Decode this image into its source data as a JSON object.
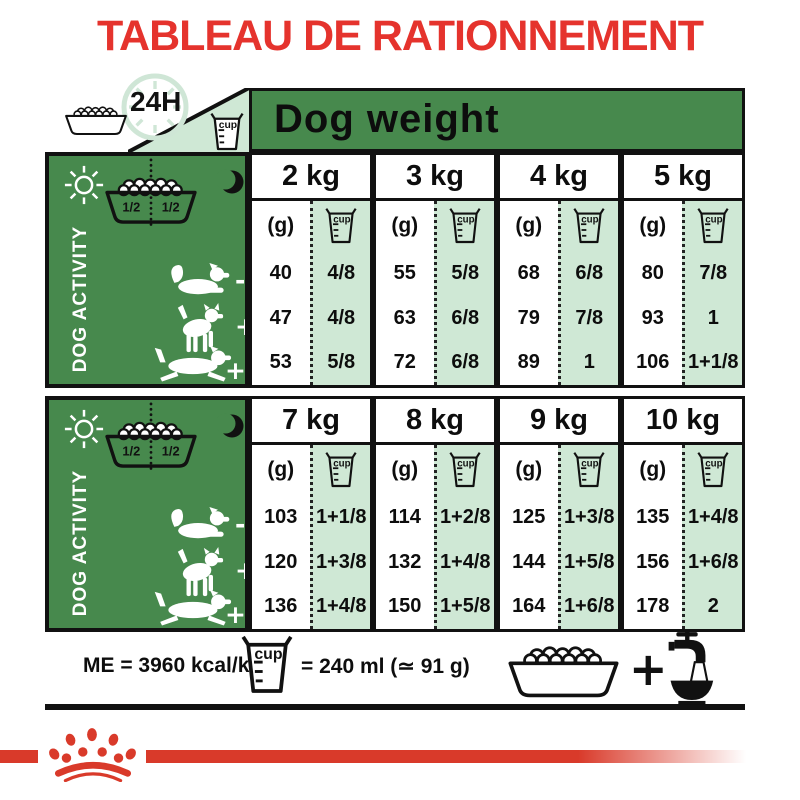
{
  "title": "TABLEAU DE RATIONNEMENT",
  "top_bar": {
    "hours_label": "24H",
    "dog_weight_label": "Dog weight",
    "cup_label": "cup"
  },
  "activity_panel": {
    "label": "DOG ACTIVITY",
    "bowl_left_half": "1/2",
    "bowl_right_half": "1/2"
  },
  "unit_label": "(g)",
  "cup_label": "cup",
  "tables": [
    {
      "weights": [
        "2 kg",
        "3 kg",
        "4 kg",
        "5 kg"
      ],
      "rows": [
        {
          "activity": "low",
          "marker": "-",
          "cells": [
            {
              "g": "40",
              "cup": "4/8"
            },
            {
              "g": "55",
              "cup": "5/8"
            },
            {
              "g": "68",
              "cup": "6/8"
            },
            {
              "g": "80",
              "cup": "7/8"
            }
          ]
        },
        {
          "activity": "medium",
          "marker": "+",
          "cells": [
            {
              "g": "47",
              "cup": "4/8"
            },
            {
              "g": "63",
              "cup": "6/8"
            },
            {
              "g": "79",
              "cup": "7/8"
            },
            {
              "g": "93",
              "cup": "1"
            }
          ]
        },
        {
          "activity": "high",
          "marker": "++",
          "cells": [
            {
              "g": "53",
              "cup": "5/8"
            },
            {
              "g": "72",
              "cup": "6/8"
            },
            {
              "g": "89",
              "cup": "1"
            },
            {
              "g": "106",
              "cup": "1+1/8"
            }
          ]
        }
      ]
    },
    {
      "weights": [
        "7 kg",
        "8 kg",
        "9 kg",
        "10 kg"
      ],
      "rows": [
        {
          "activity": "low",
          "marker": "-",
          "cells": [
            {
              "g": "103",
              "cup": "1+1/8"
            },
            {
              "g": "114",
              "cup": "1+2/8"
            },
            {
              "g": "125",
              "cup": "1+3/8"
            },
            {
              "g": "135",
              "cup": "1+4/8"
            }
          ]
        },
        {
          "activity": "medium",
          "marker": "+",
          "cells": [
            {
              "g": "120",
              "cup": "1+3/8"
            },
            {
              "g": "132",
              "cup": "1+4/8"
            },
            {
              "g": "144",
              "cup": "1+5/8"
            },
            {
              "g": "156",
              "cup": "1+6/8"
            }
          ]
        },
        {
          "activity": "high",
          "marker": "++",
          "cells": [
            {
              "g": "136",
              "cup": "1+4/8"
            },
            {
              "g": "150",
              "cup": "1+5/8"
            },
            {
              "g": "164",
              "cup": "1+6/8"
            },
            {
              "g": "178",
              "cup": "2"
            }
          ]
        }
      ]
    }
  ],
  "footer": {
    "me_label": "ME = 3960 kcal/kg",
    "cup_equals_label": "= 240 ml (≃ 91 g)",
    "plus_label": "+"
  },
  "colors": {
    "green": "#47894d",
    "light_green": "#cfe8d5",
    "clock_green": "#cfe6d6",
    "title_red": "#e5332d",
    "brand_red": "#d93a2a",
    "ink": "#111111"
  }
}
